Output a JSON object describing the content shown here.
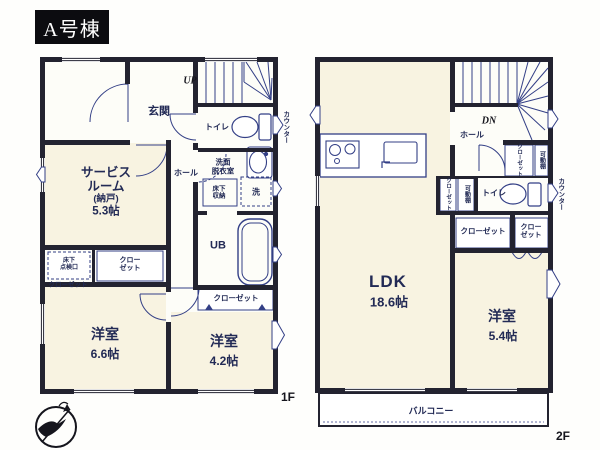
{
  "title": "A号棟",
  "colors": {
    "wall": "#232330",
    "ink": "#333f86",
    "room_fill": "#f8f3e1",
    "text": "#222a55"
  },
  "floor1": {
    "floor_label": "1F",
    "labels": {
      "entrance": "玄関",
      "stairs_up": "UP",
      "toilet": "トイレ",
      "counter": "カウンター",
      "washroom": [
        "洗面",
        "脱衣室"
      ],
      "underfloor_storage": [
        "床下",
        "収納"
      ],
      "laundry": "洗",
      "unit_bath": "UB",
      "hall": "ホール",
      "service_room": [
        "サービス",
        "ルーム",
        "(納戸)",
        "5.3帖"
      ],
      "inspection_hatch": [
        "床下",
        "点検口"
      ],
      "closet_stack": [
        "クロー",
        "ゼット"
      ],
      "closet_note": "クローゼット",
      "bedroom1": "洋室",
      "bedroom1_size": "6.6帖",
      "bedroom2_closet": "クローゼット",
      "bedroom2": "洋室",
      "bedroom2_size": "4.2帖"
    }
  },
  "floor2": {
    "floor_label": "2F",
    "labels": {
      "stairs_dn": "DN",
      "hall": "ホール",
      "upper_closet": "クローゼット",
      "upper_shelf": "可動棚",
      "side_closet": "クローゼット",
      "side_shelf": "可動棚",
      "toilet": "トイレ",
      "counter": "カウンター",
      "closet_h": "クローゼット",
      "closet_stack": [
        "クロー",
        "ゼット"
      ],
      "ldk": "LDK",
      "ldk_size": "18.6帖",
      "bedroom": "洋室",
      "bedroom_size": "5.4帖",
      "balcony": "バルコニー"
    }
  }
}
